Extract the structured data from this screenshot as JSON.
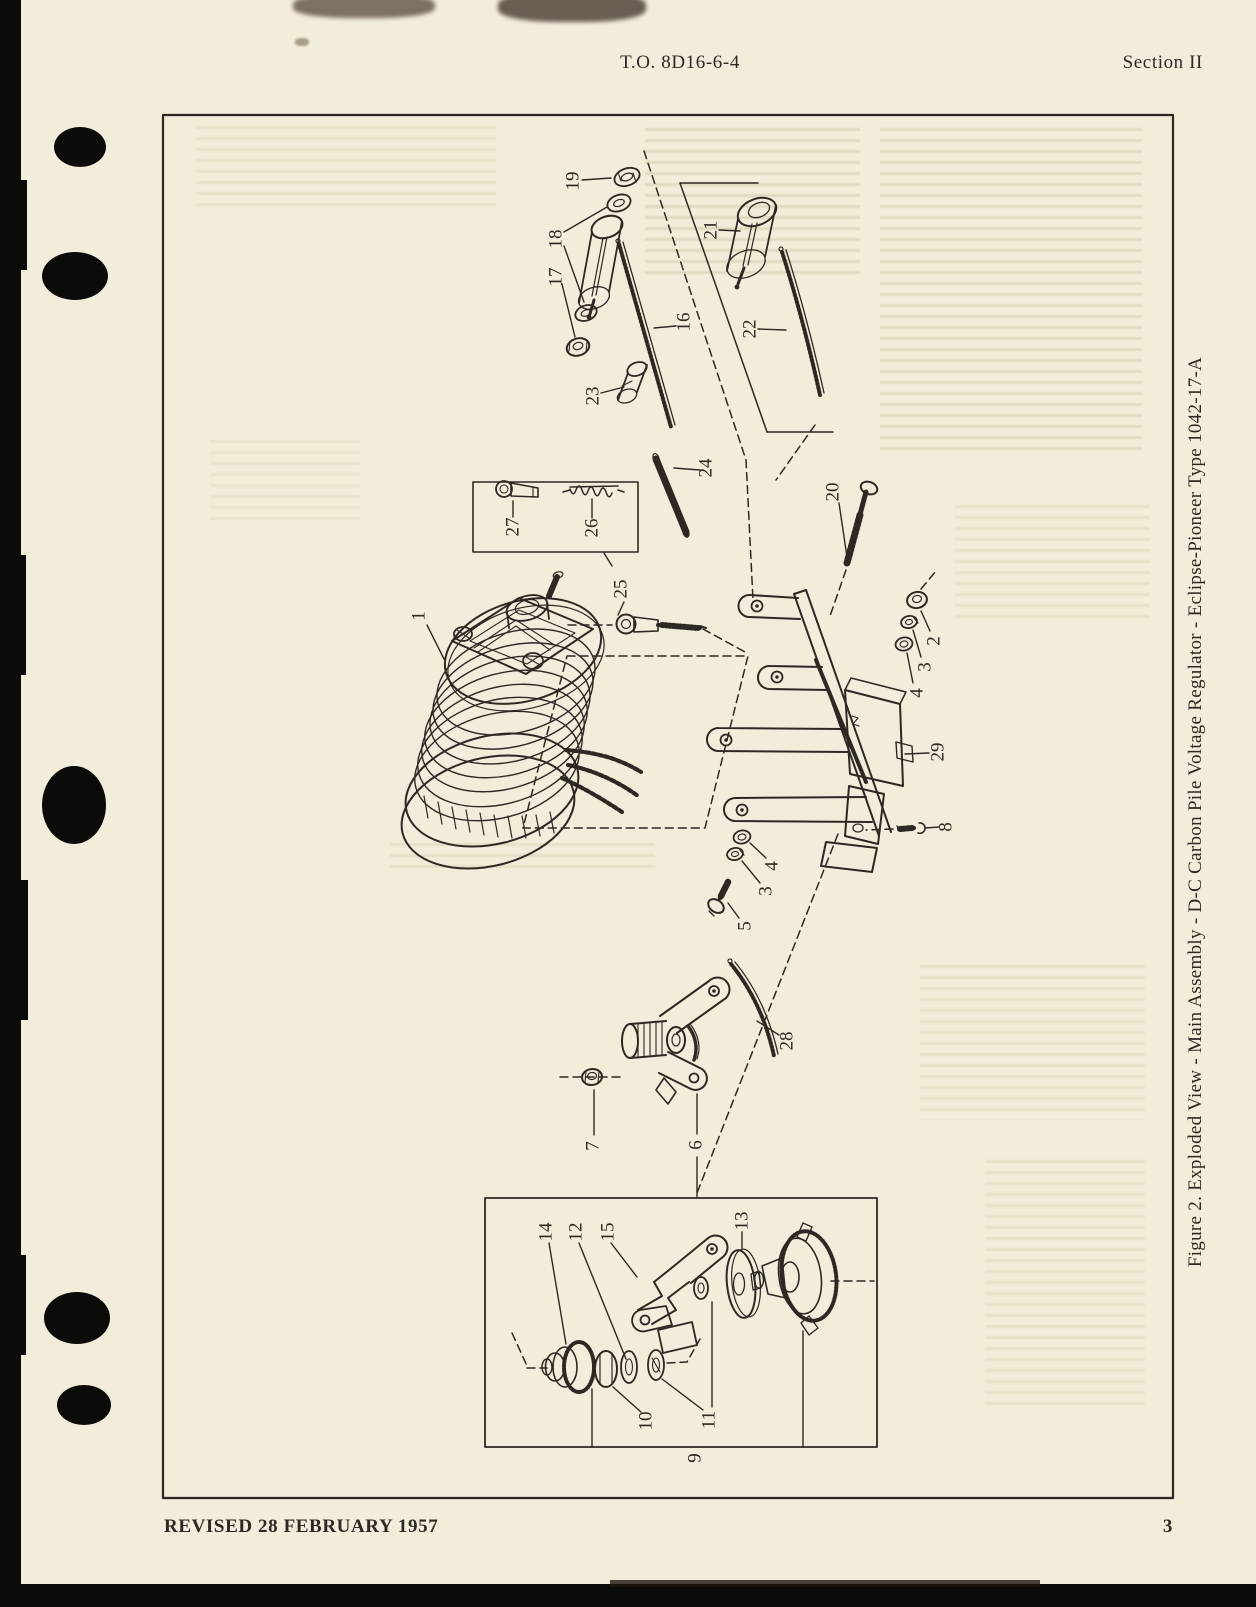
{
  "page": {
    "header_center": "T.O. 8D16-6-4",
    "header_right": "Section II",
    "footer_left": "REVISED 28 FEBRUARY 1957",
    "footer_right": "3"
  },
  "figure": {
    "type": "exploded-parts-diagram",
    "caption": "Figure 2.  Exploded View - Main Assembly - D-C Carbon Pile Voltage Regulator - Eclipse-Pioneer Type 1042-17-A",
    "part_callouts": [
      {
        "label": "1",
        "x": 419,
        "y": 616,
        "leaders": [
          [
            427,
            625,
            444,
            659
          ]
        ]
      },
      {
        "label": "19",
        "x": 573,
        "y": 181,
        "leaders": [
          [
            582,
            180,
            611,
            178
          ]
        ]
      },
      {
        "label": "18",
        "x": 556,
        "y": 239,
        "leaders": [
          [
            564,
            232,
            607,
            207
          ],
          [
            564,
            246,
            584,
            302
          ]
        ]
      },
      {
        "label": "17",
        "x": 556,
        "y": 277,
        "leaders": [
          [
            562,
            284,
            575,
            337
          ]
        ]
      },
      {
        "label": "23",
        "x": 593,
        "y": 396,
        "leaders": [
          [
            601,
            393,
            624,
            387
          ]
        ]
      },
      {
        "label": "16",
        "x": 684,
        "y": 322,
        "leaders": [
          [
            676,
            326,
            654,
            328
          ]
        ]
      },
      {
        "label": "24",
        "x": 706,
        "y": 468,
        "leaders": [
          [
            700,
            470,
            674,
            468
          ]
        ]
      },
      {
        "label": "21",
        "x": 711,
        "y": 230,
        "leaders": [
          [
            719,
            230,
            740,
            231
          ]
        ]
      },
      {
        "label": "22",
        "x": 750,
        "y": 329,
        "leaders": [
          [
            758,
            329,
            786,
            330
          ]
        ]
      },
      {
        "label": "20",
        "x": 833,
        "y": 492,
        "leaders": [
          [
            839,
            503,
            847,
            557
          ]
        ]
      },
      {
        "label": "25",
        "x": 621,
        "y": 589,
        "leaders": [
          [
            612,
            566,
            604,
            553
          ],
          [
            624,
            602,
            618,
            615
          ]
        ]
      },
      {
        "label": "26",
        "x": 592,
        "y": 528,
        "leaders": [
          [
            592,
            518,
            592,
            499
          ]
        ]
      },
      {
        "label": "27",
        "x": 513,
        "y": 527,
        "leaders": [
          [
            513,
            517,
            513,
            501
          ]
        ]
      },
      {
        "label": "2",
        "x": 934,
        "y": 641,
        "leaders": [
          [
            930,
            631,
            921,
            611
          ]
        ]
      },
      {
        "label": "3",
        "x": 925,
        "y": 667,
        "leaders": [
          [
            921,
            657,
            913,
            630
          ]
        ]
      },
      {
        "label": "4",
        "x": 917,
        "y": 693,
        "leaders": [
          [
            913,
            683,
            907,
            653
          ]
        ]
      },
      {
        "label": "29",
        "x": 938,
        "y": 752,
        "leaders": [
          [
            929,
            753,
            905,
            754
          ]
        ]
      },
      {
        "label": "8",
        "x": 946,
        "y": 827,
        "leaders": [
          [
            939,
            827,
            925,
            828
          ]
        ]
      },
      {
        "label": "4",
        "x": 772,
        "y": 866,
        "leaders": [
          [
            766,
            858,
            750,
            843
          ]
        ]
      },
      {
        "label": "3",
        "x": 766,
        "y": 891,
        "leaders": [
          [
            760,
            883,
            742,
            861
          ]
        ]
      },
      {
        "label": "5",
        "x": 745,
        "y": 926,
        "leaders": [
          [
            739,
            918,
            728,
            903
          ]
        ]
      },
      {
        "label": "28",
        "x": 787,
        "y": 1041,
        "leaders": [
          [
            779,
            1035,
            757,
            1021
          ]
        ]
      },
      {
        "label": "7",
        "x": 593,
        "y": 1146,
        "leaders": [
          [
            594,
            1135,
            594,
            1090
          ]
        ]
      },
      {
        "label": "6",
        "x": 696,
        "y": 1145,
        "leaders": [
          [
            697,
            1134,
            697,
            1094
          ],
          [
            697,
            1157,
            697,
            1197
          ]
        ]
      },
      {
        "label": "14",
        "x": 546,
        "y": 1232,
        "leaders": [
          [
            549,
            1243,
            566,
            1344
          ]
        ]
      },
      {
        "label": "12",
        "x": 576,
        "y": 1232,
        "leaders": [
          [
            579,
            1243,
            626,
            1359
          ]
        ]
      },
      {
        "label": "15",
        "x": 608,
        "y": 1232,
        "leaders": [
          [
            611,
            1243,
            637,
            1277
          ]
        ]
      },
      {
        "label": "13",
        "x": 742,
        "y": 1221,
        "leaders": [
          [
            742,
            1232,
            742,
            1249
          ]
        ]
      },
      {
        "label": "10",
        "x": 646,
        "y": 1421,
        "leaders": [
          [
            641,
            1412,
            613,
            1387
          ]
        ]
      },
      {
        "label": "11",
        "x": 709,
        "y": 1420,
        "leaders": [
          [
            703,
            1410,
            662,
            1379
          ],
          [
            712,
            1407,
            712,
            1302
          ]
        ]
      },
      {
        "label": "9",
        "x": 695,
        "y": 1458,
        "leaders": []
      }
    ]
  },
  "colors": {
    "paper": "#f2edda",
    "ink": "#2d2822",
    "edge_black": "#0b0b09"
  }
}
